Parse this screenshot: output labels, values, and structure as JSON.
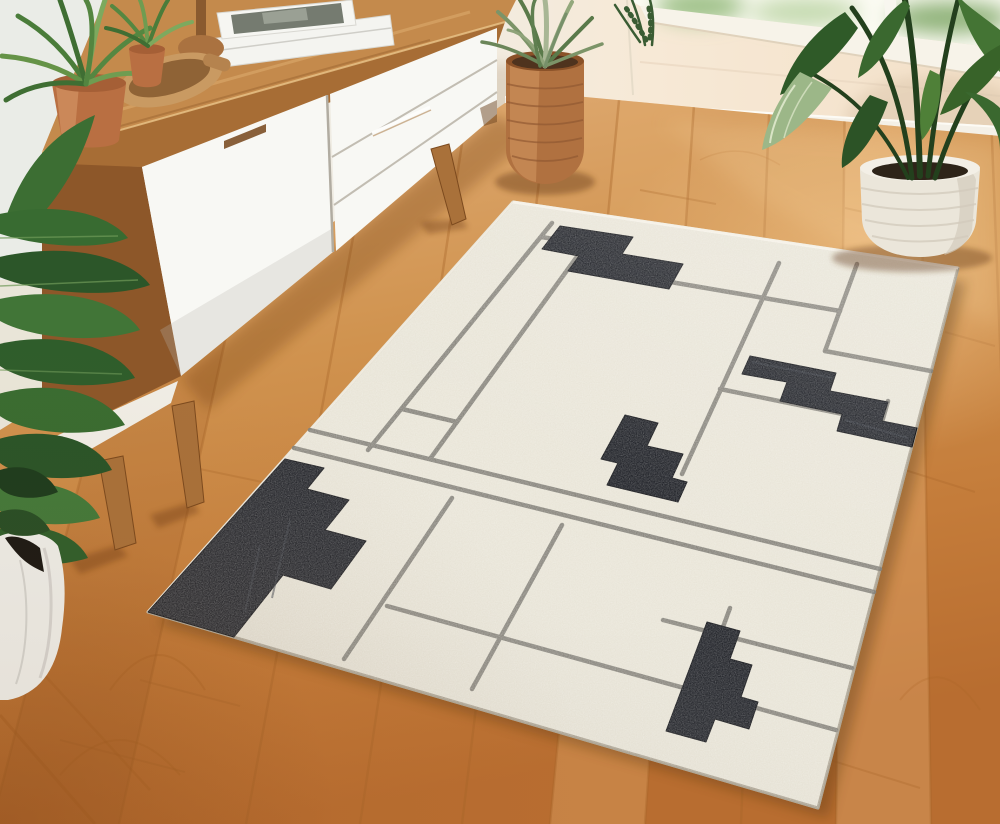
{
  "meta": {
    "title": "Living room scene with abstract area rug",
    "kind": "photograph-recreation",
    "no_visible_text": true
  },
  "scene": {
    "description": "Mid-century modern room: walnut sideboard with white fronts at left, warm oak plank floor, bright window at top right, five potted plants, and a large ivory wool rug with abstract charcoal pixel blocks and taupe map-like gridlines, laid diagonally.",
    "furniture": {
      "sideboard": "mid-century walnut sideboard with white door and drawers, tapered legs",
      "decor": [
        "stack of white books",
        "wooden candle holder",
        "wooden bowl with scoop"
      ]
    },
    "plants": [
      {
        "name": "spider plant in terracotta pot",
        "position": "on sideboard top left"
      },
      {
        "name": "small spider plant in terracotta pot",
        "position": "on sideboard behind bowl"
      },
      {
        "name": "philodendron in white marble pot",
        "position": "floor bottom left"
      },
      {
        "name": "grass plant in woven jute basket",
        "position": "floor top center"
      },
      {
        "name": "palm in white rope pot",
        "position": "floor top right by window"
      }
    ],
    "rug": {
      "style": "ivory hand-tufted rug, abstract city-map design",
      "motifs": "5 pixelated charcoal blocks, thin taupe gridlines, double-line band across lower third"
    },
    "colors": {
      "wall_left": "#eaece7",
      "wall_right": "#f6e8d5",
      "window_light": "#fcfbf3",
      "baseboard": "#f4f0e7",
      "floor_mid": "#cf8f4e",
      "floor_seam": "#a8662a",
      "rug_field": "#e9e5d8",
      "rug_lines": "#86847c",
      "rug_black": "#22242a",
      "rug_edge": "#dcd7c7",
      "wood_top": "#c48a4c",
      "wood_face": "#a76d35",
      "wood_side": "#8d5729",
      "wood_leg": "#a9713a",
      "cabinet_white": "#f8f8f4",
      "terracotta": "#b96f42",
      "basket": "#b07140",
      "rope_pot": "#ebe6da",
      "marble_pot": "#edece6",
      "leaf_dark": "#27522a",
      "leaf_mid": "#3e6b33",
      "leaf_light": "#5f8f46",
      "grass_green": "#7c9468",
      "soil": "#2e2419"
    }
  }
}
